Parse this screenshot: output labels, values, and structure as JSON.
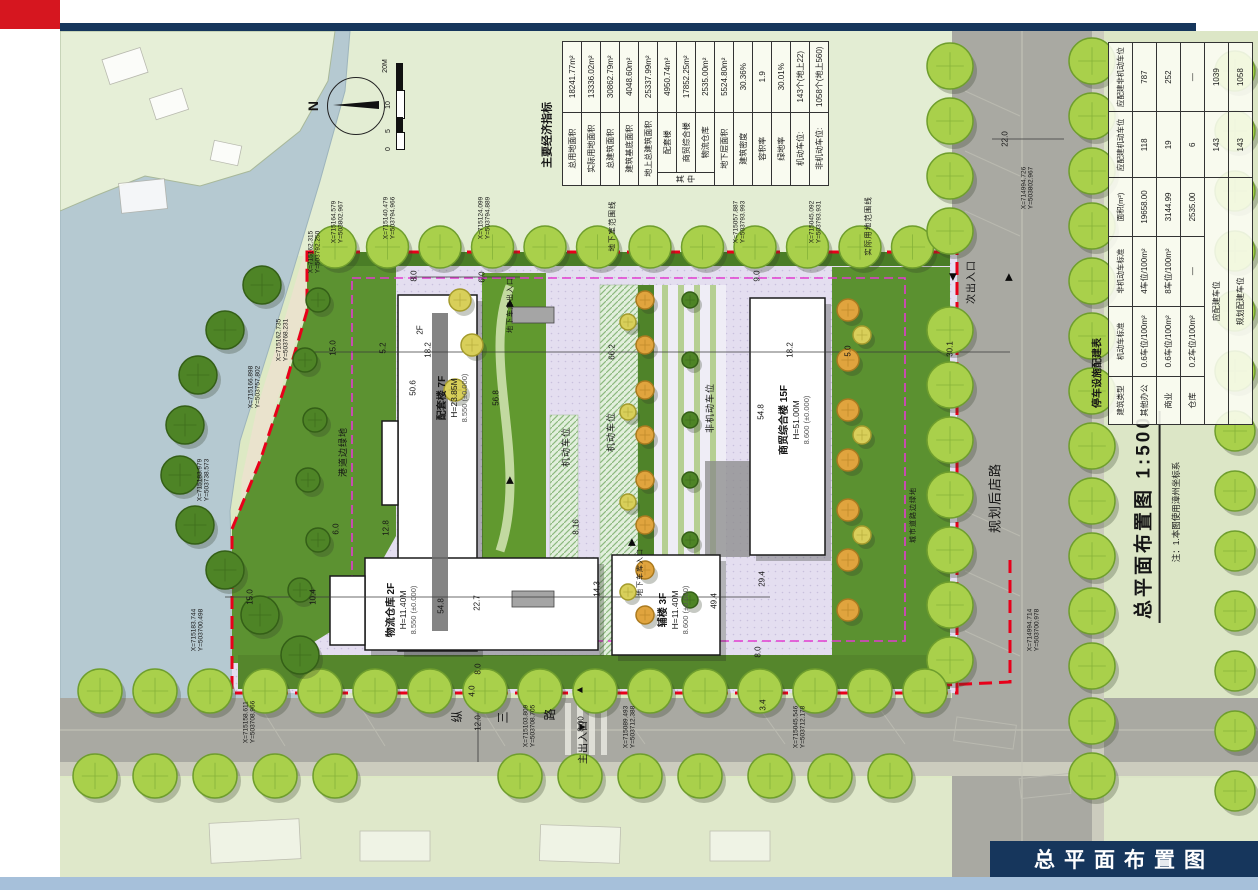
{
  "slide": {
    "footer_title": "总平面布置图"
  },
  "plan": {
    "title": "总平面布置图",
    "scale": "1:500",
    "note": "注：1.本图使用漳州坐标系",
    "north": "N",
    "scalebar": [
      "0",
      "5",
      "10",
      "20M"
    ]
  },
  "econ": {
    "title": "主要经济指标",
    "group": "其中",
    "rows": [
      {
        "l": "总用地面积",
        "v": "18241.77m²"
      },
      {
        "l": "实际用地面积",
        "v": "13336.02m²"
      },
      {
        "l": "总建筑面积",
        "v": "30862.79m²"
      },
      {
        "l": "建筑基底面积",
        "v": "4048.60m²"
      },
      {
        "l": "地上总建筑面积",
        "v": "25337.99m²"
      },
      {
        "l": "配套楼",
        "v": "4950.74m²"
      },
      {
        "l": "商贸综合楼",
        "v": "17852.25m²"
      },
      {
        "l": "物流仓库",
        "v": "2535.00m²"
      },
      {
        "l": "地下层面积",
        "v": "5524.80m²"
      },
      {
        "l": "建筑密度",
        "v": "30.36%"
      },
      {
        "l": "容积率",
        "v": "1.9"
      },
      {
        "l": "绿地率",
        "v": "30.01%"
      },
      {
        "l": "机动车位:",
        "v": "143个(地上22)"
      },
      {
        "l": "非机动车位:",
        "v": "1058个(地上560)"
      }
    ]
  },
  "parking": {
    "title": "停车设施配建表",
    "headers": [
      "建筑类型",
      "机动车标准",
      "非机动车标准",
      "面积(m²)",
      "应配建机动车位",
      "应配建非机动车位"
    ],
    "rows": [
      [
        "其他办公",
        "0.6车位/100m²",
        "4车位/100m²",
        "19658.00",
        "118",
        "787"
      ],
      [
        "商业",
        "0.6车位/100m²",
        "8车位/100m²",
        "3144.99",
        "19",
        "252"
      ],
      [
        "仓库",
        "0.2车位/100m²",
        "—",
        "2535.00",
        "6",
        "—"
      ]
    ],
    "totals": [
      {
        "l": "应配建车位",
        "m": "143",
        "n": "1039"
      },
      {
        "l": "规划配建车位",
        "m": "143",
        "n": "1058"
      }
    ]
  },
  "buildings": [
    {
      "name": "配套楼 7F",
      "h": "H=23.85M",
      "e": "8.550 (±0.000)",
      "annex": "2F"
    },
    {
      "name": "商贸综合楼 15F",
      "h": "H=51.00M",
      "e": "8.600 (±0.000)"
    },
    {
      "name": "物流仓库 2F",
      "h": "H=11.40M",
      "e": "8.550 (±0.000)"
    },
    {
      "name": "辅楼 3F",
      "h": "H=11.40M",
      "e": "8.600 (±0.000)"
    }
  ],
  "labels": {
    "gangdao": "港道边绿地",
    "dixiashi": "地下室范围线",
    "shiji": "实际用地范围线",
    "jidong": "机动车位",
    "feijidong": "非机动车位",
    "cheku": "地下车库出入口",
    "cheku2": "地下车库入口",
    "main": "主出入口",
    "sec": "次出入口",
    "houdian": "规划后店路",
    "zong": "纵",
    "san": "三",
    "lu": "路",
    "chengshi": "城市道路边绿地"
  },
  "dims": [
    "15.0",
    "15.0",
    "10.4",
    "5.2",
    "18.2",
    "50.6",
    "56.8",
    "12.8",
    "8.0",
    "6.0",
    "9.0",
    "66.2",
    "18.2",
    "5.0",
    "30.1",
    "22.0",
    "54.8",
    "22.7",
    "14.3",
    "49.4",
    "29.4",
    "8.0",
    "4.0",
    "12.0",
    "8.00",
    "3.4",
    "8.0",
    "6.0",
    "8.16",
    "54.8"
  ],
  "coords": [
    {
      "x": "X=715164.579",
      "y": "Y=503802.967"
    },
    {
      "x": "X=715162.315",
      "y": "Y=503792.250"
    },
    {
      "x": "X=715140.479",
      "y": "Y=503794.966"
    },
    {
      "x": "X=715124.099",
      "y": "Y=503794.889"
    },
    {
      "x": "X=715057.887",
      "y": "Y=503793.993"
    },
    {
      "x": "X=715045.092",
      "y": "Y=503793.931"
    },
    {
      "x": "X=714994.726",
      "y": "Y=503802.967"
    },
    {
      "x": "X=715162.735",
      "y": "Y=503768.231"
    },
    {
      "x": "X=715166.898",
      "y": "Y=503757.802"
    },
    {
      "x": "X=715183.979",
      "y": "Y=503738.573"
    },
    {
      "x": "X=715183.744",
      "y": "Y=503700.498"
    },
    {
      "x": "X=715158.611",
      "y": "Y=503708.966"
    },
    {
      "x": "X=715103.809",
      "y": "Y=503708.705"
    },
    {
      "x": "X=715089.493",
      "y": "Y=503712.388"
    },
    {
      "x": "X=715045.546",
      "y": "Y=503712.178"
    },
    {
      "x": "X=714994.714",
      "y": "Y=503700.978"
    }
  ]
}
